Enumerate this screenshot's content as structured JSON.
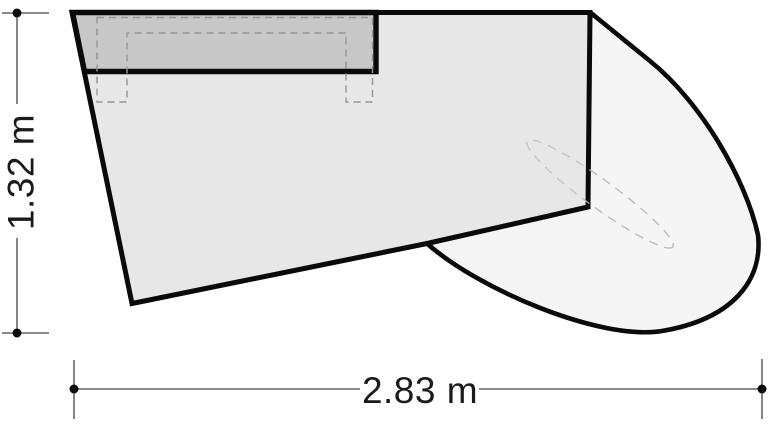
{
  "drawing": {
    "kind": "dimensioned plan-view technical drawing",
    "labels": {
      "height": "1.32 m",
      "width": "2.83 m"
    },
    "colors": {
      "outline": "#0a0a0a",
      "body_fill": "#e7e7e7",
      "panel_fill": "#c7c7c7",
      "wing_fill": "#f5f5f5",
      "hidden_dash": "#969696",
      "ellipse_dash": "#c0c0c0",
      "dimension_line": "#444444",
      "background": "#ffffff"
    }
  }
}
